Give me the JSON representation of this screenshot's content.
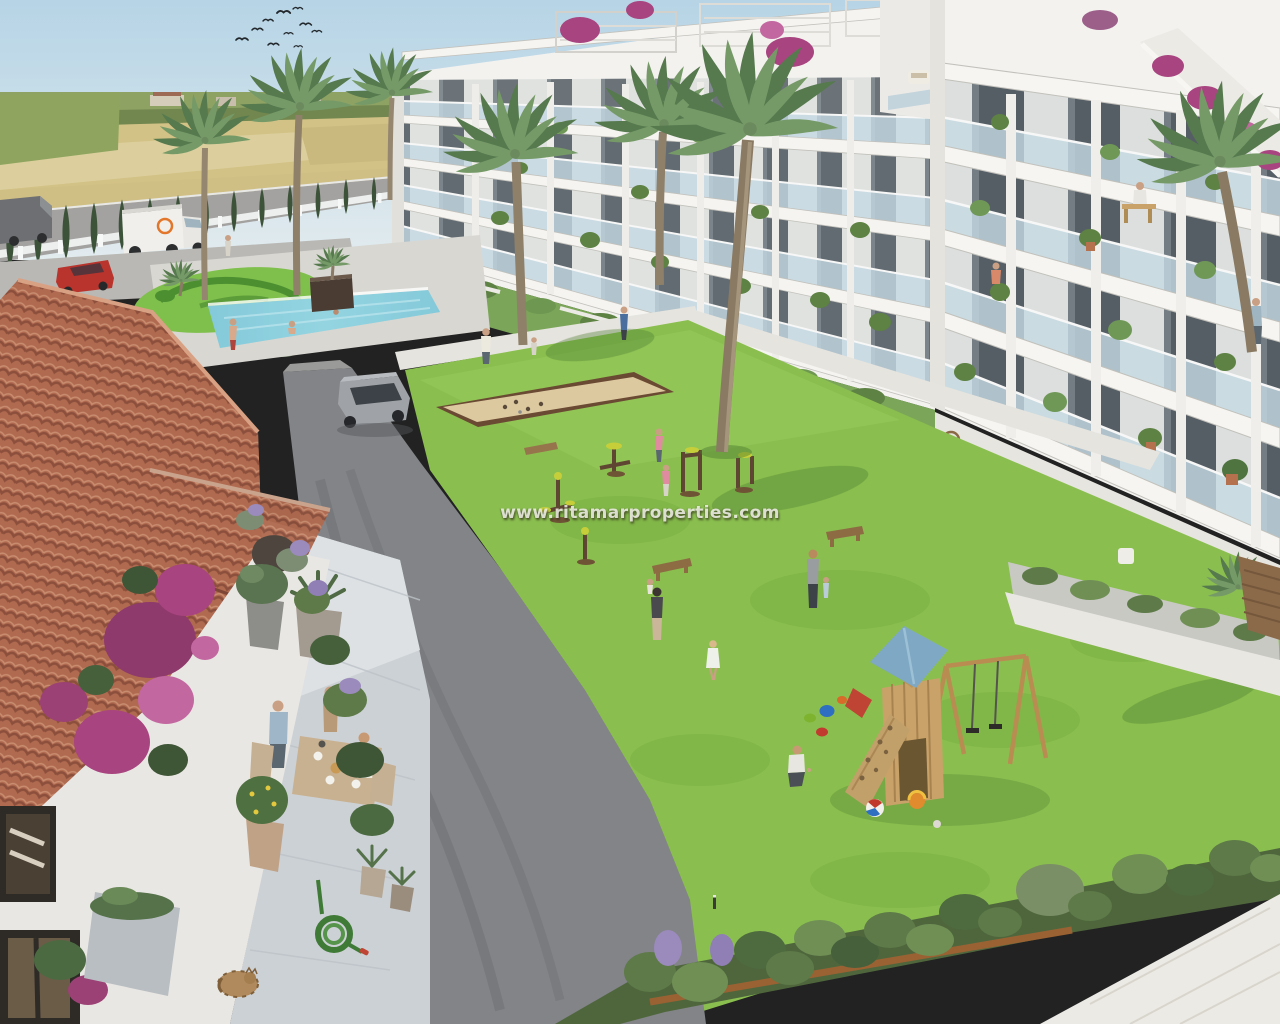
{
  "image": {
    "type": "3d-architectural-render",
    "subject": "Aerial render of a Mediterranean residential complex: white apartment blocks with glass balconies around landscaped gardens with swimming pool, communal lawn, outdoor gym, petanque court and a children's playground; terracotta-roofed villa terrace with a family dining in the foreground; farm fields and a perimeter road with cypress hedge in the background",
    "watermark": {
      "text": "www.ritamarproperties.com"
    }
  },
  "colors": {
    "sky": "#b6d4e6",
    "horizon": "#e2ebee",
    "field": "#d3c286",
    "field_light": "#ddd0a0",
    "treeline": "#7c8f5e",
    "grass": "#8abf4f",
    "swirl_lawn": "#7fbf4c",
    "swirl_hedge": "#4c8f31",
    "pool_water": "#8fd0de",
    "pool_deck": "#d8d7d2",
    "building_white": "#f3f2ef",
    "window_dark": "#39434c",
    "balcony_glass": "#c6d9e3",
    "roof_tile": "#b06a50",
    "terrace_stone": "#ccd1d5",
    "asphalt": "#828487",
    "upper_road": "#a3a2a0",
    "cypress": "#3c5339",
    "bougainvillea": "#a8447f",
    "lavender": "#9b8abc",
    "petanque_sand": "#dcc9a0",
    "playground_wood": "#c8a269",
    "playground_roof": "#7ea8c4",
    "truck_logo": "#e2762a",
    "car_red": "#b8342c",
    "suv_gray": "#9fa3a7",
    "watermark_text": "#faf9f3"
  },
  "scene": {
    "background": [
      "sky",
      "flock-of-birds",
      "farm-fields",
      "distant-treeline",
      "perimeter-road",
      "white-fence",
      "cypress-hedge",
      "box-truck",
      "delivery-van",
      "red-car"
    ],
    "middle": [
      "ornamental-swirl-garden",
      "swimming-pool",
      "pool-deck",
      "center-apartment-block",
      "right-apartment-block",
      "roof-pergolas",
      "balcony-plants",
      "palm-trees",
      "residents-on-balconies"
    ],
    "foreground": [
      "communal-lawn",
      "petanque-court",
      "outdoor-gym",
      "wooden-benches",
      "children-playground",
      "swing-set",
      "climbing-ramp",
      "beach-balls",
      "toy-buckets",
      "asphalt-driveway",
      "grey-suv",
      "villa-terracotta-roof",
      "terrace-dining-family",
      "bougainvillea",
      "garden-statue",
      "potted-olive-tree",
      "agave-pot",
      "lemon-tree-pot",
      "garden-hose",
      "sleeping-cat",
      "lavender-bed",
      "white-walkway"
    ]
  }
}
